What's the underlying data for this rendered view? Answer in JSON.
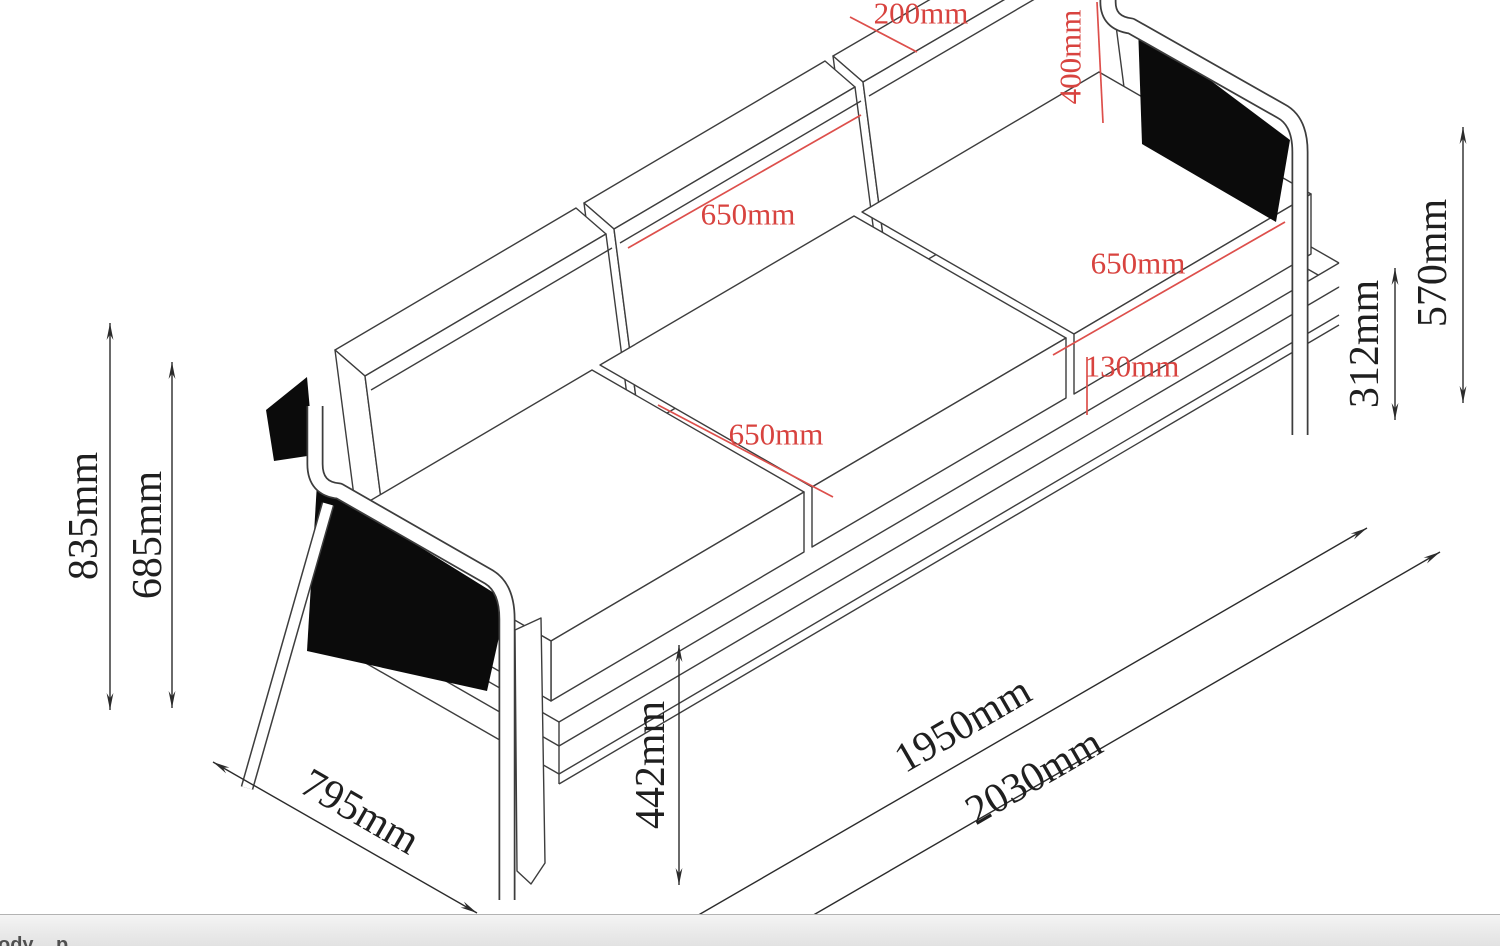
{
  "drawing": {
    "type": "furniture-dimension-drawing",
    "subject": "three-seat sofa isometric line drawing",
    "colors": {
      "dimension_red": "#d8433f",
      "line_black": "#3d3d3d",
      "panel_black": "#0b0b0b",
      "background": "#ffffff",
      "statusbar_gray": "#e8e8e8"
    },
    "dims": {
      "r200": "200mm",
      "r400": "400mm",
      "r650_backrest": "650mm",
      "r650_seat_depth": "650mm",
      "r650_seat_width": "650mm",
      "r130": "130mm",
      "h835": "835mm",
      "h685": "685mm",
      "h442": "442mm",
      "h312": "312mm",
      "h570": "570mm",
      "d795": "795mm",
      "l1950": "1950mm",
      "l2030": "2030mm"
    }
  },
  "statusbar": {
    "items": [
      "ody",
      "p"
    ]
  }
}
